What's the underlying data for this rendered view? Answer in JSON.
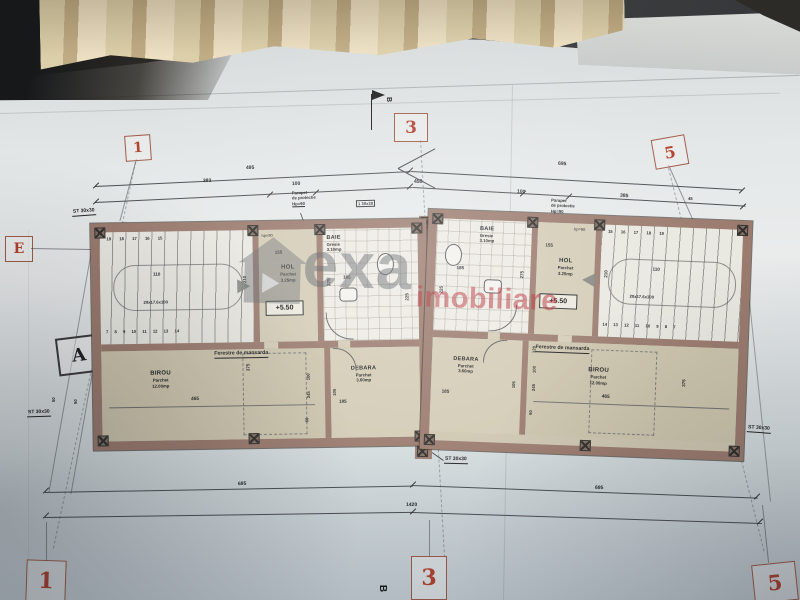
{
  "watermark": {
    "brand_gray": "exa",
    "brand_red": "imobiliare"
  },
  "axis_markers": {
    "top1": "1",
    "top3": "3",
    "top5": "5",
    "bottom1": "1",
    "bottom3": "3",
    "bottom5": "5",
    "e": "E",
    "a": "A",
    "section_b": "B"
  },
  "dimensions": {
    "top_row1_left": "495",
    "top_row1_right": "695",
    "top_row2": [
      "383",
      "100",
      "450",
      "100",
      "385",
      "45"
    ],
    "bottom_left": "695",
    "bottom_right": "695",
    "bottom_total": "1420",
    "diag_left_1": "50",
    "diag_left_2": "50",
    "d465": "465",
    "d375": "375",
    "d245": "245",
    "d100": "100",
    "d60": "60",
    "d120": "120",
    "d185": "185",
    "d275": "275",
    "d225": "225",
    "d105": "105",
    "d110": "110",
    "d210": "210",
    "d155": "155"
  },
  "annotations": {
    "parapet_line1": "Parapet",
    "parapet_line2": "de protectie",
    "parapet_line3": "Hp=90",
    "column_label": "ST 30x30",
    "lintel_label": "1 30x20",
    "mansard_windows": "Ferestre de mansarda",
    "stair_spec": "20x17.6x100",
    "level_mark": "+5.50",
    "hp_small": "hp=90"
  },
  "rooms": {
    "birou": {
      "name": "BIROU",
      "finish": "Parchet",
      "area": "12.00mp"
    },
    "hol": {
      "name": "HOL",
      "finish": "Parchet",
      "area": "3.25mp"
    },
    "baie": {
      "name": "BAIE",
      "finish": "Gresie",
      "area": "3.10mp"
    },
    "debara": {
      "name": "DEBARA",
      "finish": "Parchet",
      "area": "3.60mp"
    }
  },
  "stairs": {
    "left_top_numbers": "19 18 17 16 15",
    "left_bottom_numbers": "7 8 9 10 11 12 13 14",
    "right_top_numbers": "15 16 17 18 19",
    "right_bottom_numbers": "14 13 12 11 10 9 8 7"
  }
}
